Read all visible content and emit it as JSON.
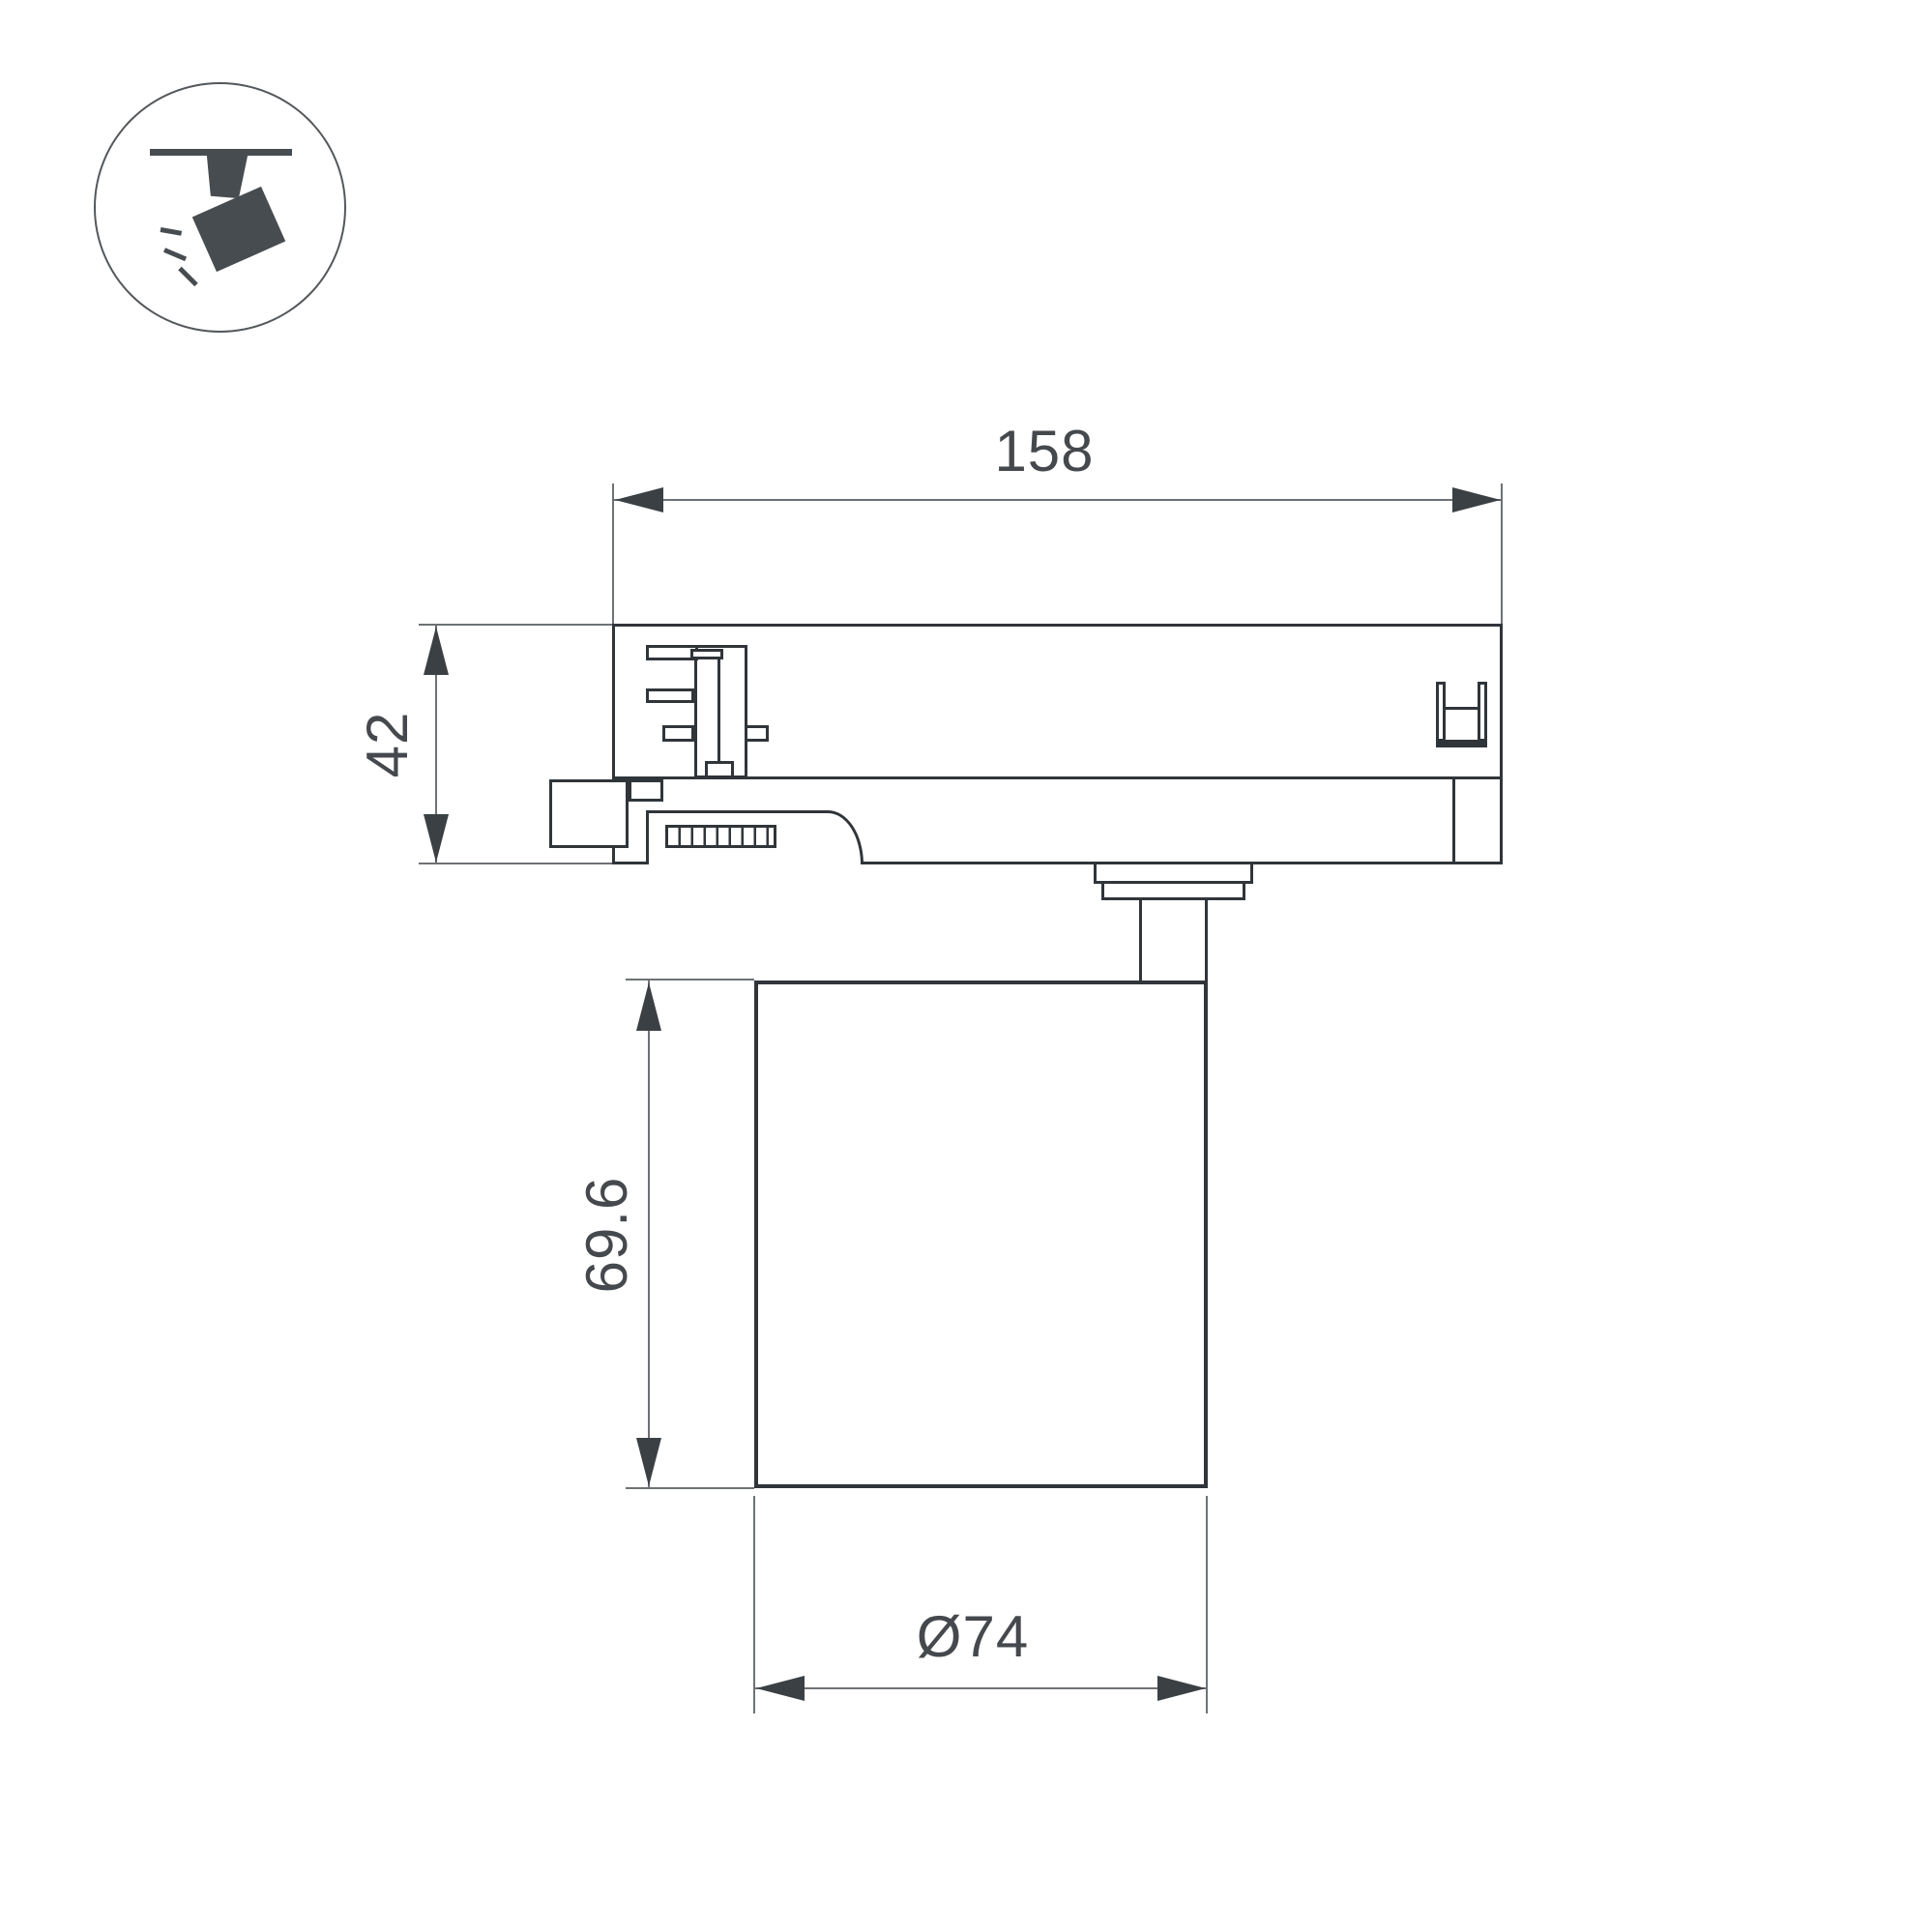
{
  "drawing": {
    "type": "technical-dimension-drawing",
    "subject": "track-mounted spotlight, side view",
    "dimensions": {
      "adapter_width": "158",
      "adapter_height": "42",
      "lamp_height": "69.6",
      "lamp_diameter": "Ø74"
    },
    "colors": {
      "dark": "#30353a",
      "dim": "#6e7275",
      "arrow": "#3b4044",
      "txt": "#45494d",
      "icon": "#474c50",
      "bg": "#ffffff"
    },
    "icon": {
      "name": "track-spotlight-icon",
      "description": "spotlight hanging from track emitting light rays"
    }
  }
}
